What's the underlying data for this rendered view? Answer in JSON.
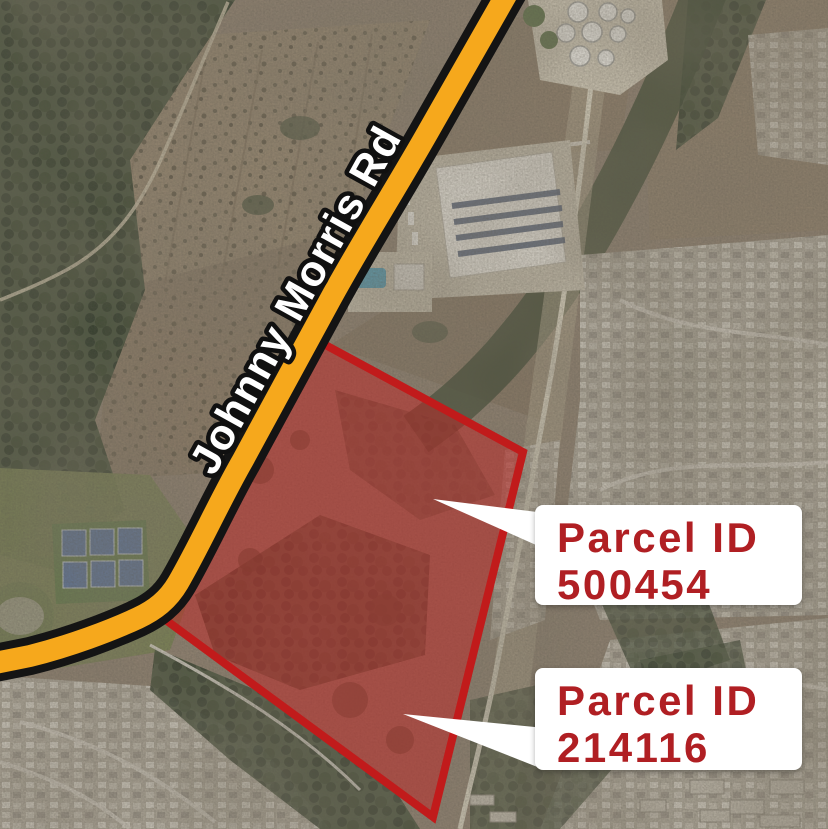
{
  "map": {
    "type": "satellite-annotated-parcel-map",
    "road_label": "Johnny Morris Rd",
    "parcel_callouts": [
      {
        "title": "Parcel ID",
        "parcel_id": "500454"
      },
      {
        "title": "Parcel ID",
        "parcel_id": "214116"
      }
    ],
    "colors": {
      "road_fill": "#F6A81C",
      "road_casing": "#141414",
      "parcel_border": "#C11B1B",
      "parcel_fill_rgba": "rgba(197,32,32,0.47)",
      "callout_text": "#B01F23",
      "callout_bg": "#FFFFFF",
      "road_label_fill": "#FFFFFF",
      "road_label_outline": "#101010"
    }
  }
}
